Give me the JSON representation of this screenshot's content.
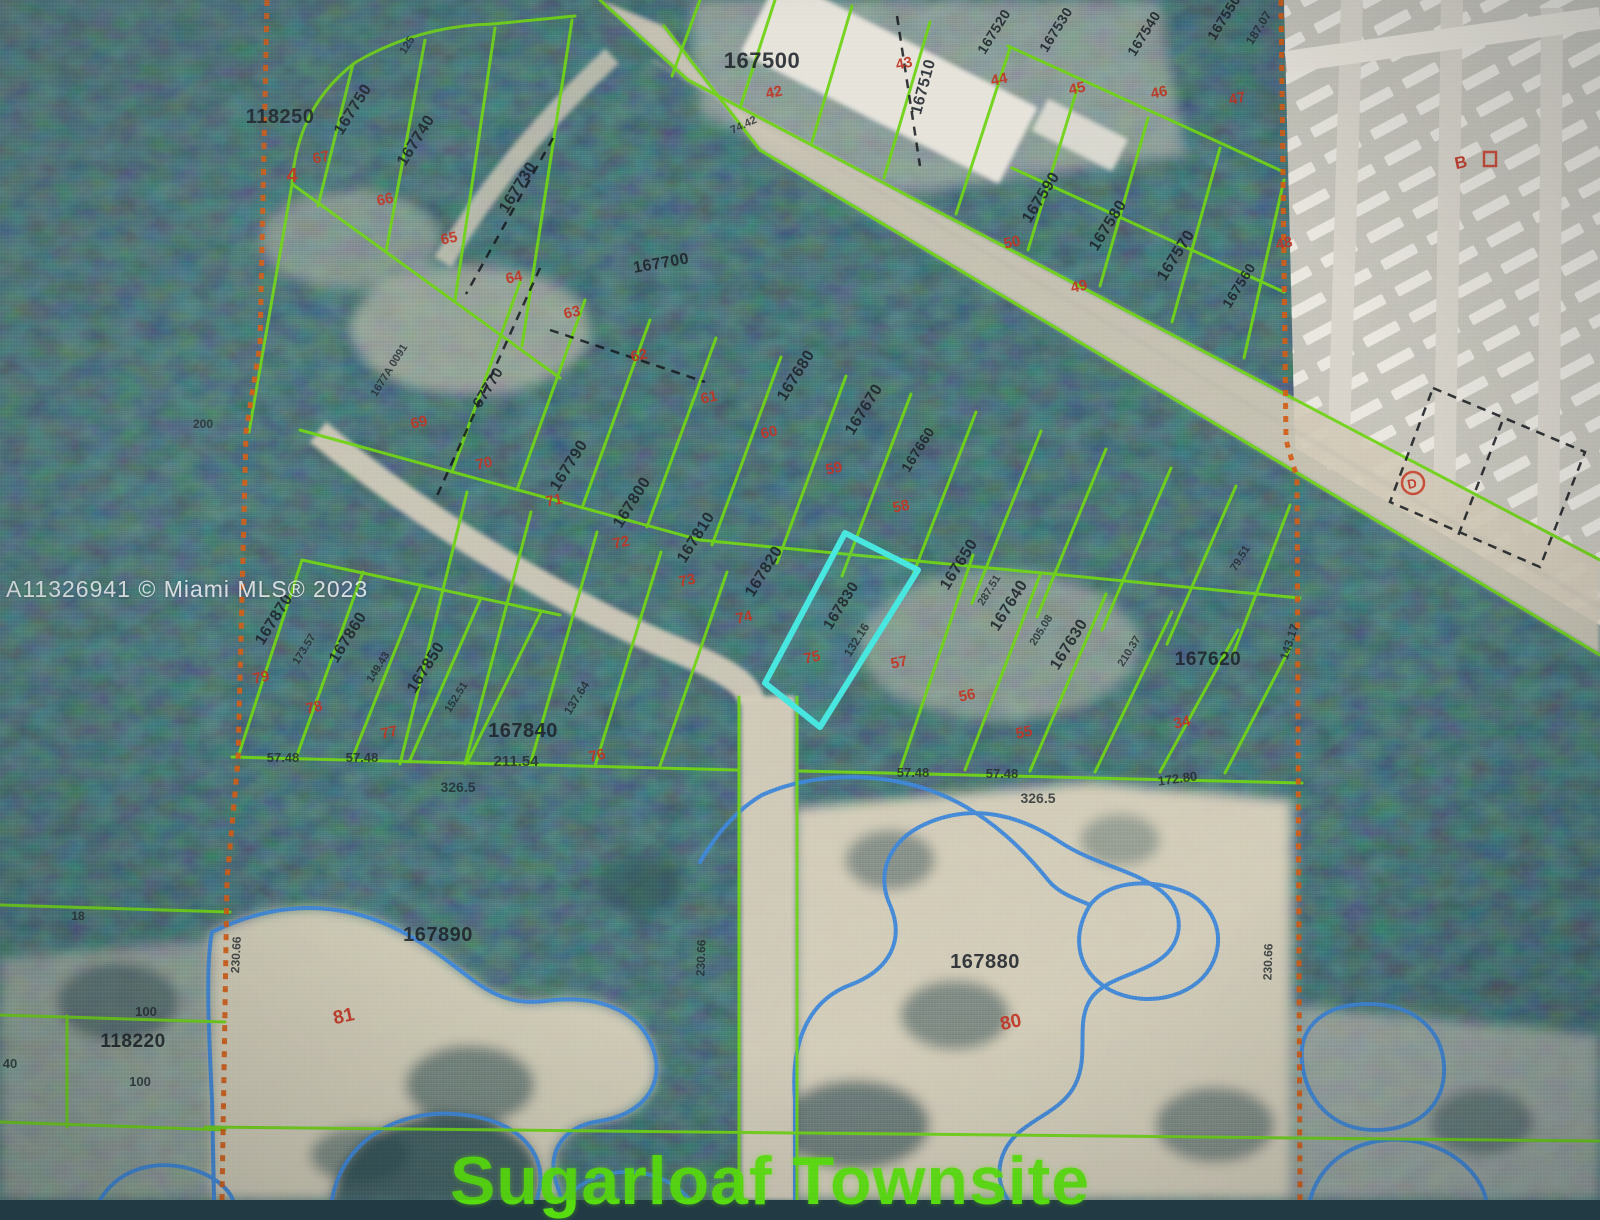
{
  "map": {
    "watermark": "A11326941 © Miami MLS® 2023",
    "townsite_label": "Sugarloaf Townsite",
    "colors": {
      "parcel_line": "#6fd318",
      "highlight_outline": "#47e6df",
      "lot_number": "#c03524",
      "section_line": "#d15c17",
      "water_line": "#3f86d8",
      "townsite_text": "#5be60d",
      "parcel_label": "#1d232a"
    },
    "highlighted_parcel": {
      "id": "167830",
      "lot": "75",
      "frontage": "132.16"
    },
    "labels": [
      {
        "id": "parcel-118250",
        "t": "118250",
        "x": 280,
        "y": 123,
        "r": 0,
        "c": "p",
        "s": 20
      },
      {
        "id": "lot-4",
        "t": "4",
        "x": 292,
        "y": 182,
        "r": 0,
        "c": "r",
        "s": 20
      },
      {
        "id": "parcel-167750",
        "t": "167750",
        "x": 357,
        "y": 112,
        "r": -58,
        "c": "p"
      },
      {
        "id": "parcel-167740",
        "t": "167740",
        "x": 420,
        "y": 143,
        "r": -58,
        "c": "p"
      },
      {
        "id": "parcel-167730",
        "t": "167730",
        "x": 522,
        "y": 190,
        "r": -58,
        "c": "p"
      },
      {
        "id": "parcel-67770",
        "t": "67770",
        "x": 492,
        "y": 390,
        "r": -58,
        "c": "p",
        "s": 15
      },
      {
        "id": "parcel-1677a-0091",
        "t": "1677A 0091",
        "x": 392,
        "y": 372,
        "r": -58,
        "c": "m",
        "s": 11
      },
      {
        "id": "parcel-167700",
        "t": "167700",
        "x": 662,
        "y": 268,
        "r": -10,
        "c": "p"
      },
      {
        "id": "parcel-167500",
        "t": "167500",
        "x": 762,
        "y": 68,
        "r": 0,
        "c": "p",
        "s": 22
      },
      {
        "id": "parcel-167510",
        "t": "167510",
        "x": 928,
        "y": 88,
        "r": -75,
        "c": "p"
      },
      {
        "id": "parcel-167520",
        "t": "167520",
        "x": 998,
        "y": 34,
        "r": -58,
        "c": "p",
        "s": 14
      },
      {
        "id": "parcel-167530",
        "t": "167530",
        "x": 1060,
        "y": 32,
        "r": -58,
        "c": "p",
        "s": 14
      },
      {
        "id": "parcel-167540",
        "t": "167540",
        "x": 1148,
        "y": 36,
        "r": -58,
        "c": "p",
        "s": 14
      },
      {
        "id": "parcel-167550",
        "t": "167550",
        "x": 1228,
        "y": 20,
        "r": -58,
        "c": "p",
        "s": 14
      },
      {
        "id": "meas-187-07",
        "t": "187.07",
        "x": 1262,
        "y": 30,
        "r": -58,
        "c": "m"
      },
      {
        "id": "parcel-167590",
        "t": "167590",
        "x": 1045,
        "y": 200,
        "r": -58,
        "c": "p"
      },
      {
        "id": "parcel-167580",
        "t": "167580",
        "x": 1112,
        "y": 228,
        "r": -58,
        "c": "p"
      },
      {
        "id": "parcel-167570",
        "t": "167570",
        "x": 1180,
        "y": 258,
        "r": -58,
        "c": "p"
      },
      {
        "id": "parcel-167560",
        "t": "167560",
        "x": 1243,
        "y": 288,
        "r": -58,
        "c": "p",
        "s": 14
      },
      {
        "id": "parcel-167680",
        "t": "167680",
        "x": 800,
        "y": 378,
        "r": -58,
        "c": "p"
      },
      {
        "id": "parcel-167670",
        "t": "167670",
        "x": 868,
        "y": 412,
        "r": -58,
        "c": "p"
      },
      {
        "id": "parcel-167660",
        "t": "167660",
        "x": 922,
        "y": 452,
        "r": -58,
        "c": "p",
        "s": 14
      },
      {
        "id": "parcel-167650",
        "t": "167650",
        "x": 963,
        "y": 567,
        "r": -58,
        "c": "p"
      },
      {
        "id": "meas-287-51",
        "t": "287.51",
        "x": 992,
        "y": 592,
        "r": -58,
        "c": "m",
        "s": 11
      },
      {
        "id": "parcel-167640",
        "t": "167640",
        "x": 1013,
        "y": 608,
        "r": -58,
        "c": "p"
      },
      {
        "id": "meas-205-08",
        "t": "205.08",
        "x": 1044,
        "y": 632,
        "r": -58,
        "c": "m",
        "s": 11
      },
      {
        "id": "parcel-167630",
        "t": "167630",
        "x": 1073,
        "y": 647,
        "r": -58,
        "c": "p"
      },
      {
        "id": "meas-210-37",
        "t": "210.37",
        "x": 1132,
        "y": 653,
        "r": -58,
        "c": "m",
        "s": 11
      },
      {
        "id": "parcel-167620",
        "t": "167620",
        "x": 1208,
        "y": 665,
        "r": 0,
        "c": "p",
        "s": 19
      },
      {
        "id": "meas-143-17",
        "t": "143.17",
        "x": 1293,
        "y": 643,
        "r": -72,
        "c": "m"
      },
      {
        "id": "meas-79-51",
        "t": "79.51",
        "x": 1243,
        "y": 560,
        "r": -58,
        "c": "m",
        "s": 11
      },
      {
        "id": "parcel-167790",
        "t": "167790",
        "x": 573,
        "y": 468,
        "r": -58,
        "c": "p"
      },
      {
        "id": "parcel-167800",
        "t": "167800",
        "x": 636,
        "y": 505,
        "r": -58,
        "c": "p"
      },
      {
        "id": "parcel-167810",
        "t": "167810",
        "x": 700,
        "y": 540,
        "r": -58,
        "c": "p"
      },
      {
        "id": "parcel-167820",
        "t": "167820",
        "x": 768,
        "y": 574,
        "r": -58,
        "c": "p"
      },
      {
        "id": "parcel-167830",
        "t": "167830",
        "x": 845,
        "y": 608,
        "r": -58,
        "c": "p",
        "s": 15
      },
      {
        "id": "meas-132-16",
        "t": "132.16",
        "x": 860,
        "y": 642,
        "r": -58,
        "c": "m"
      },
      {
        "id": "parcel-167870",
        "t": "167870",
        "x": 278,
        "y": 622,
        "r": -58,
        "c": "p"
      },
      {
        "id": "meas-173-57",
        "t": "173.57",
        "x": 307,
        "y": 651,
        "r": -58,
        "c": "m",
        "s": 11
      },
      {
        "id": "parcel-167860",
        "t": "167860",
        "x": 352,
        "y": 640,
        "r": -58,
        "c": "p"
      },
      {
        "id": "meas-149-43",
        "t": "149.43",
        "x": 381,
        "y": 669,
        "r": -58,
        "c": "m",
        "s": 11
      },
      {
        "id": "parcel-167850",
        "t": "167850",
        "x": 430,
        "y": 670,
        "r": -58,
        "c": "p"
      },
      {
        "id": "meas-152-51",
        "t": "152.51",
        "x": 459,
        "y": 699,
        "r": -58,
        "c": "m",
        "s": 11
      },
      {
        "id": "parcel-167840",
        "t": "167840",
        "x": 523,
        "y": 737,
        "r": 0,
        "c": "p",
        "s": 20
      },
      {
        "id": "meas-211-54",
        "t": "211.54",
        "x": 516,
        "y": 766,
        "r": 0,
        "c": "m",
        "s": 15
      },
      {
        "id": "meas-57-48-a",
        "t": "57.48",
        "x": 283,
        "y": 762,
        "r": 0,
        "c": "m",
        "s": 13
      },
      {
        "id": "meas-57-48-b",
        "t": "57.48",
        "x": 362,
        "y": 762,
        "r": 0,
        "c": "m",
        "s": 13
      },
      {
        "id": "meas-326-5-a",
        "t": "326.5",
        "x": 458,
        "y": 792,
        "r": 0,
        "c": "m",
        "s": 14
      },
      {
        "id": "meas-137-64",
        "t": "137.64",
        "x": 580,
        "y": 700,
        "r": -58,
        "c": "m"
      },
      {
        "id": "meas-57-48-c",
        "t": "57.48",
        "x": 913,
        "y": 777,
        "r": 0,
        "c": "m",
        "s": 13
      },
      {
        "id": "meas-57-48-d",
        "t": "57.48",
        "x": 1002,
        "y": 778,
        "r": 0,
        "c": "m",
        "s": 13
      },
      {
        "id": "meas-326-5-b",
        "t": "326.5",
        "x": 1038,
        "y": 803,
        "r": 0,
        "c": "m",
        "s": 14
      },
      {
        "id": "meas-172-80",
        "t": "172.80",
        "x": 1178,
        "y": 783,
        "r": -8,
        "c": "m",
        "s": 13
      },
      {
        "id": "parcel-167890",
        "t": "167890",
        "x": 438,
        "y": 941,
        "r": 0,
        "c": "p",
        "s": 20
      },
      {
        "id": "parcel-167880",
        "t": "167880",
        "x": 985,
        "y": 968,
        "r": 0,
        "c": "p",
        "s": 20
      },
      {
        "id": "parcel-118220",
        "t": "118220",
        "x": 133,
        "y": 1047,
        "r": 0,
        "c": "p",
        "s": 19
      },
      {
        "id": "meas-100-a",
        "t": "100",
        "x": 146,
        "y": 1016,
        "r": 0,
        "c": "m",
        "s": 13
      },
      {
        "id": "meas-100-b",
        "t": "100",
        "x": 140,
        "y": 1086,
        "r": 0,
        "c": "m",
        "s": 13
      },
      {
        "id": "meas-40",
        "t": "40",
        "x": 10,
        "y": 1068,
        "r": 0,
        "c": "m",
        "s": 13
      },
      {
        "id": "meas-200",
        "t": "200",
        "x": 203,
        "y": 428,
        "r": 0,
        "c": "m"
      },
      {
        "id": "meas-230-66-a",
        "t": "230.66",
        "x": 240,
        "y": 955,
        "r": -87,
        "c": "m"
      },
      {
        "id": "meas-230-66-b",
        "t": "230.66",
        "x": 705,
        "y": 958,
        "r": -88,
        "c": "m"
      },
      {
        "id": "meas-230-66-c",
        "t": "230.66",
        "x": 1272,
        "y": 962,
        "r": -88,
        "c": "m"
      },
      {
        "id": "meas-18",
        "t": "18",
        "x": 78,
        "y": 920,
        "r": 0,
        "c": "m"
      },
      {
        "id": "meas-125",
        "t": "125",
        "x": 410,
        "y": 47,
        "r": -58,
        "c": "m",
        "s": 11
      },
      {
        "id": "meas-74-42",
        "t": "74.42",
        "x": 745,
        "y": 128,
        "r": -25,
        "c": "m",
        "s": 11
      },
      {
        "id": "lot-67",
        "t": "67",
        "x": 322,
        "y": 162,
        "c": "r"
      },
      {
        "id": "lot-66",
        "t": "66",
        "x": 386,
        "y": 204,
        "c": "r"
      },
      {
        "id": "lot-65",
        "t": "65",
        "x": 450,
        "y": 243,
        "c": "r"
      },
      {
        "id": "lot-64",
        "t": "64",
        "x": 515,
        "y": 282,
        "c": "r"
      },
      {
        "id": "lot-63",
        "t": "63",
        "x": 573,
        "y": 317,
        "c": "r"
      },
      {
        "id": "lot-62",
        "t": "62",
        "x": 640,
        "y": 360,
        "c": "r"
      },
      {
        "id": "lot-61",
        "t": "61",
        "x": 710,
        "y": 402,
        "c": "r"
      },
      {
        "id": "lot-60",
        "t": "60",
        "x": 770,
        "y": 437,
        "c": "r"
      },
      {
        "id": "lot-59",
        "t": "59",
        "x": 835,
        "y": 473,
        "c": "r"
      },
      {
        "id": "lot-58",
        "t": "58",
        "x": 902,
        "y": 511,
        "c": "r"
      },
      {
        "id": "lot-57",
        "t": "57",
        "x": 900,
        "y": 667,
        "c": "r"
      },
      {
        "id": "lot-56",
        "t": "56",
        "x": 968,
        "y": 700,
        "c": "r"
      },
      {
        "id": "lot-55",
        "t": "55",
        "x": 1025,
        "y": 737,
        "c": "r"
      },
      {
        "id": "lot-34",
        "t": "34",
        "x": 1183,
        "y": 727,
        "c": "r"
      },
      {
        "id": "lot-42",
        "t": "42",
        "x": 775,
        "y": 97,
        "c": "r"
      },
      {
        "id": "lot-43",
        "t": "43",
        "x": 905,
        "y": 68,
        "c": "r"
      },
      {
        "id": "lot-44",
        "t": "44",
        "x": 1000,
        "y": 84,
        "c": "r"
      },
      {
        "id": "lot-45",
        "t": "45",
        "x": 1078,
        "y": 93,
        "c": "r"
      },
      {
        "id": "lot-46",
        "t": "46",
        "x": 1160,
        "y": 97,
        "c": "r"
      },
      {
        "id": "lot-47",
        "t": "47",
        "x": 1238,
        "y": 103,
        "c": "r"
      },
      {
        "id": "lot-50",
        "t": "50",
        "x": 1013,
        "y": 247,
        "c": "r"
      },
      {
        "id": "lot-49",
        "t": "49",
        "x": 1080,
        "y": 291,
        "c": "r"
      },
      {
        "id": "lot-48",
        "t": "48",
        "x": 1285,
        "y": 248,
        "c": "r"
      },
      {
        "id": "lot-69",
        "t": "69",
        "x": 420,
        "y": 427,
        "c": "r"
      },
      {
        "id": "lot-70",
        "t": "70",
        "x": 485,
        "y": 468,
        "c": "r"
      },
      {
        "id": "lot-71",
        "t": "71",
        "x": 555,
        "y": 505,
        "c": "r"
      },
      {
        "id": "lot-72",
        "t": "72",
        "x": 622,
        "y": 547,
        "c": "r"
      },
      {
        "id": "lot-73",
        "t": "73",
        "x": 688,
        "y": 585,
        "c": "r"
      },
      {
        "id": "lot-74",
        "t": "74",
        "x": 745,
        "y": 622,
        "c": "r"
      },
      {
        "id": "lot-75",
        "t": "75",
        "x": 813,
        "y": 662,
        "c": "r"
      },
      {
        "id": "lot-79",
        "t": "79",
        "x": 262,
        "y": 682,
        "c": "r"
      },
      {
        "id": "lot-78",
        "t": "78",
        "x": 315,
        "y": 712,
        "c": "r"
      },
      {
        "id": "lot-77",
        "t": "77",
        "x": 390,
        "y": 737,
        "c": "r"
      },
      {
        "id": "lot-76",
        "t": "76",
        "x": 598,
        "y": 760,
        "c": "r"
      },
      {
        "id": "lot-81",
        "t": "81",
        "x": 345,
        "y": 1022,
        "c": "r",
        "s": 19
      },
      {
        "id": "lot-80",
        "t": "80",
        "x": 1012,
        "y": 1028,
        "c": "r",
        "s": 19
      },
      {
        "id": "label-b",
        "t": "B",
        "x": 1462,
        "y": 168,
        "c": "r",
        "s": 17
      },
      {
        "id": "label-d",
        "t": "D",
        "x": 1413,
        "y": 488,
        "c": "r",
        "s": 13
      }
    ]
  }
}
